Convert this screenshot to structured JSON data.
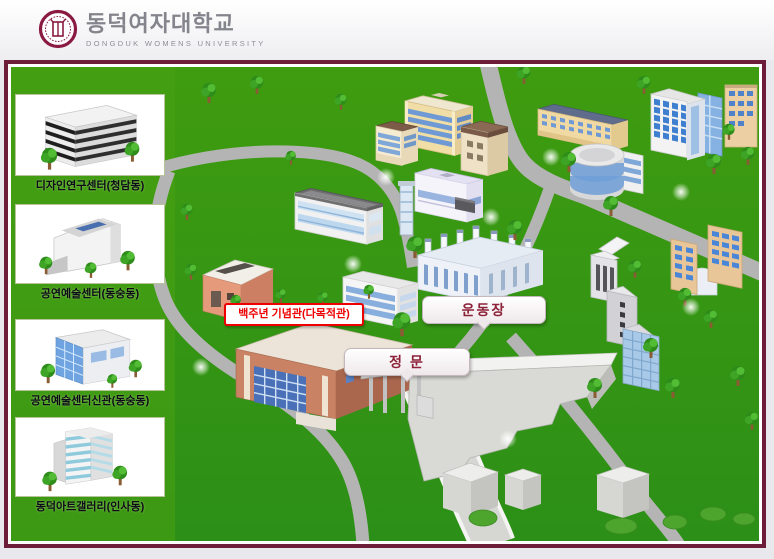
{
  "page": {
    "background": "#e9e9ed"
  },
  "header": {
    "logo_icon": "university-seal-icon",
    "title_ko": "동덕여자대학교",
    "title_en": "DONGDUK WOMENS UNIVERSITY",
    "brand_color": "#8a1a41",
    "title_color": "#84848c"
  },
  "map": {
    "frame_color": "#6e1d38",
    "grass_color": "#349114",
    "road_color": "#b4b4b4",
    "sidebar": {
      "items": [
        {
          "label": "디자인연구센터(청담동)",
          "thumbnail_icon": "design-research-center-thumb"
        },
        {
          "label": "공연예술센터(동숭동)",
          "thumbnail_icon": "performing-arts-center-thumb"
        },
        {
          "label": "공연예술센터신관(동숭동)",
          "thumbnail_icon": "performing-arts-center-annex-thumb"
        },
        {
          "label": "동덕아트갤러리(인사동)",
          "thumbnail_icon": "dongduk-art-gallery-thumb"
        }
      ]
    },
    "markers": {
      "centennial": {
        "text": "백주년 기념관(다목적관)",
        "color": "#ee0000",
        "style": "highlighted-box"
      },
      "playground": {
        "text": "운동장",
        "color": "#8c2138",
        "style": "bubble"
      },
      "main_gate": {
        "text": "정 문",
        "color": "#8c2138",
        "style": "bubble"
      }
    }
  }
}
